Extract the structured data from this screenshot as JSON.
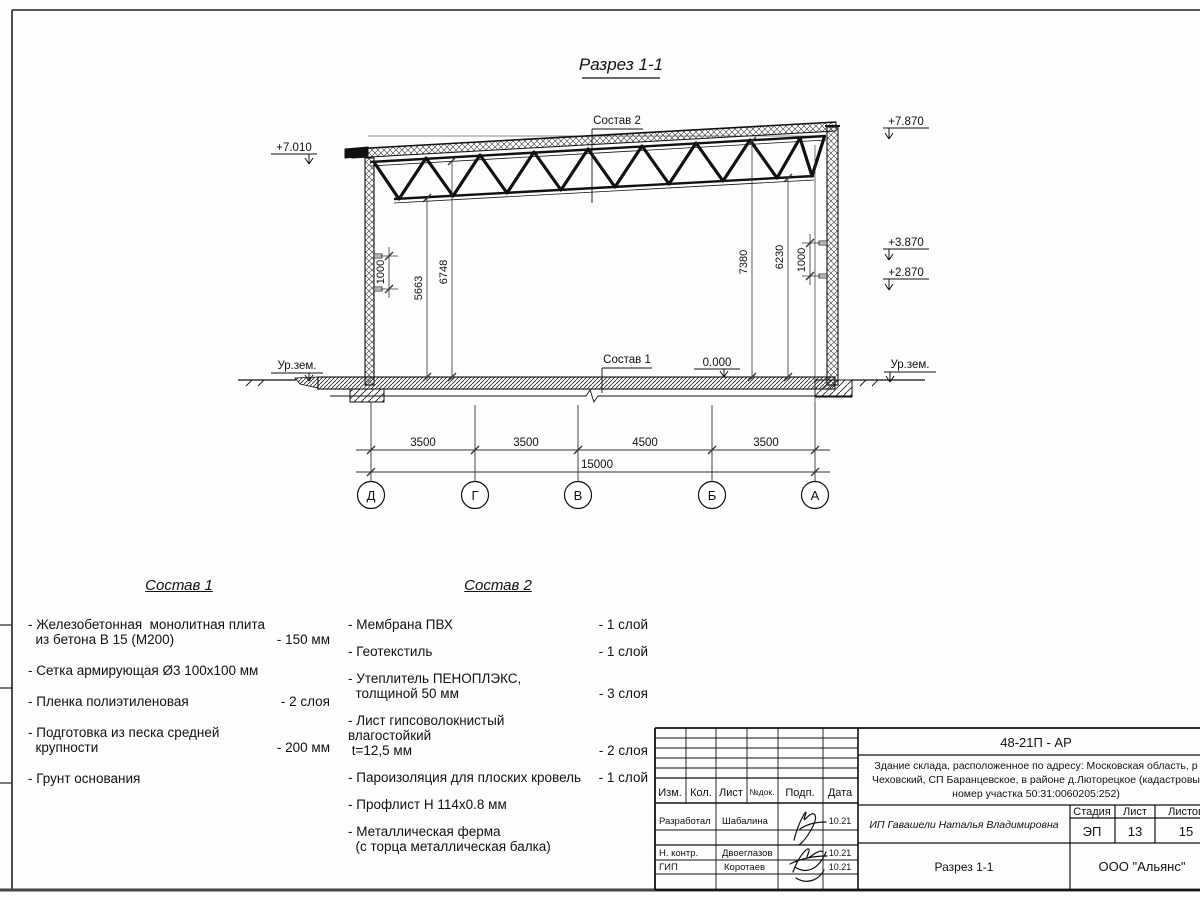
{
  "drawing": {
    "title": "Разрез 1-1",
    "labels": {
      "sostav1": "Состав 1",
      "sostav2": "Состав 2",
      "ground": "Ур.зем.",
      "zero": "0.000",
      "elev_left": "+7.010",
      "elev_r1": "+7.870",
      "elev_r2": "+3.870",
      "elev_r3": "+2.870"
    },
    "vdims": {
      "left_girt": "1000",
      "h1": "5663",
      "h2": "6748",
      "h3": "7380",
      "h4": "6230",
      "right_girt": "1000"
    },
    "hdims": {
      "d1": "3500",
      "d2": "3500",
      "d3": "4500",
      "d4": "3500",
      "total": "15000"
    },
    "axes": {
      "a1": "Д",
      "a2": "Г",
      "a3": "В",
      "a4": "Б",
      "a5": "А"
    }
  },
  "sostav1": {
    "title": "Состав 1",
    "items": [
      {
        "name": "- Железобетонная  монолитная плита\n  из бетона В 15 (М200)",
        "value": "- 150 мм"
      },
      {
        "name": "- Сетка армирующая Ø3 100х100 мм",
        "value": ""
      },
      {
        "name": "- Пленка полиэтиленовая",
        "value": "-  2 слоя"
      },
      {
        "name": "- Подготовка из песка средней\n  крупности",
        "value": "- 200 мм"
      },
      {
        "name": "- Грунт основания",
        "value": ""
      }
    ]
  },
  "sostav2": {
    "title": "Состав 2",
    "items": [
      {
        "name": "- Мембрана ПВХ",
        "value": "- 1 слой"
      },
      {
        "name": "- Геотекстиль",
        "value": "- 1 слой"
      },
      {
        "name": "- Утеплитель ПЕНОПЛЭКС,\n  толщиной 50 мм",
        "value": "- 3 слоя"
      },
      {
        "name": "- Лист гипсоволокнистый влагостойкий\n t=12,5 мм",
        "value": "- 2 слоя"
      },
      {
        "name": "- Пароизоляция для плоских кровель",
        "value": "- 1 слой"
      },
      {
        "name": "- Профлист Н 114х0.8 мм",
        "value": ""
      },
      {
        "name": "- Металлическая ферма\n  (с торца металлическая балка)",
        "value": ""
      }
    ]
  },
  "titleblock": {
    "doc_code": "48-21П - АР",
    "desc1": "Здание склада, расположенное по адресу: Московская область, р",
    "desc2": "Чеховский, СП Баранцевское, в районе д.Люторецкое  (кадастровы",
    "desc3": "номер участка 50:31:0060205:252)",
    "col_izm": "Изм.",
    "col_kol": "Кол.",
    "col_list": "Лист",
    "col_ndok": "№док.",
    "col_podp": "Подп.",
    "col_data": "Дата",
    "row1_role": "Разработал",
    "row1_name": "Шабалина",
    "row1_date": "10.21",
    "row2_role": "Н. контр.",
    "row2_name": "Двоеглазов",
    "row2_date": "10.21",
    "row3_role": "ГИП",
    "row3_name": "Коротаев",
    "row3_date": "10.21",
    "client": "ИП Гавашели Наталья Владимировна",
    "stage_label": "Стадия",
    "sheet_label": "Лист",
    "sheets_label": "Листов",
    "stage": "ЭП",
    "sheet": "13",
    "sheets": "15",
    "sheet_title": "Разрез 1-1",
    "company": "ООО \"Альянс\""
  }
}
